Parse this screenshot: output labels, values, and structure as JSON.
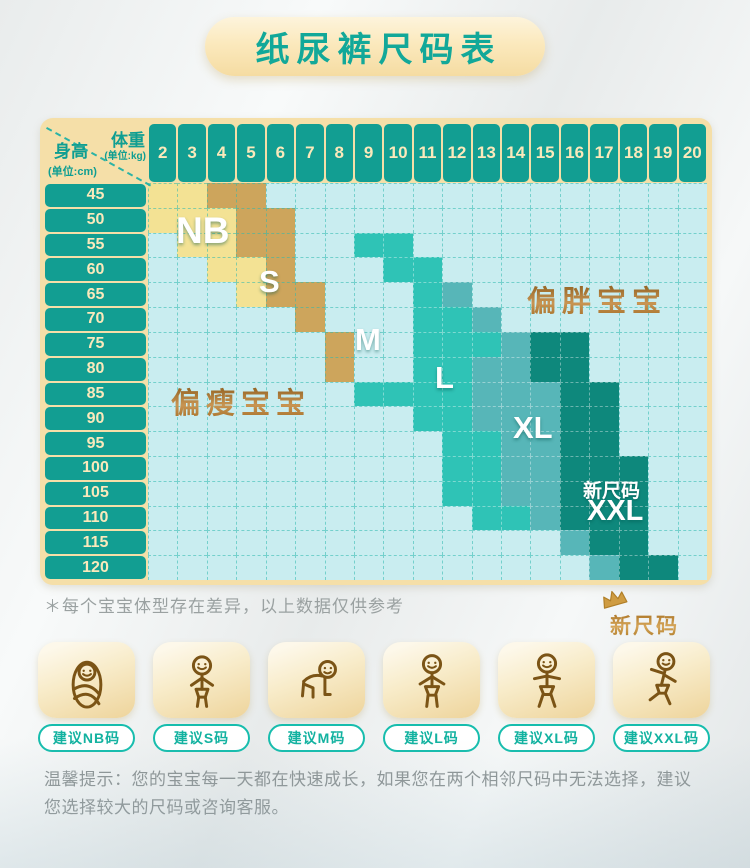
{
  "title": "纸尿裤尺码表",
  "colors": {
    "header_teal": "#129e92",
    "frame_cream": "#f5dfa8",
    "title_text": "#12a899",
    "pill_teal": "#16bdad",
    "brown_text": "#a8731f"
  },
  "table": {
    "corner": {
      "weight_label": "体重",
      "weight_unit": "(单位:kg)",
      "height_label": "身高",
      "height_unit": "(单位:cm)"
    },
    "labels": {
      "nb": "NB",
      "s": "S",
      "m": "M",
      "l": "L",
      "xl": "XL",
      "xxl": "XXL",
      "new_size": "新尺码",
      "chubby": "偏胖宝宝",
      "slim": "偏瘦宝宝"
    }
  },
  "chart_data": {
    "type": "heatmap",
    "title": "纸尿裤尺码表",
    "x_label": "体重(单位:kg)",
    "y_label": "身高(单位:cm)",
    "x": [
      "2",
      "3",
      "4",
      "5",
      "6",
      "7",
      "8",
      "9",
      "10",
      "11",
      "12",
      "13",
      "14",
      "15",
      "16",
      "17",
      "18",
      "19",
      "20"
    ],
    "y": [
      "45",
      "50",
      "55",
      "60",
      "65",
      "70",
      "75",
      "80",
      "85",
      "90",
      "95",
      "100",
      "105",
      "110",
      "115",
      "120"
    ],
    "legend": {
      "Y": "NB(浅黄)",
      "G": "S(金色)",
      "B": "背景/M标注区(浅青)",
      "L": "L(亮青绿)",
      "X": "XL(中青绿)",
      "D": "XXL新尺码(深青绿)"
    },
    "cell_code_colors": {
      "Y": "#f3e294",
      "G": "#cda55c",
      "B": "#c9edf0",
      "L": "#2fc3b6",
      "X": "#57b6b8",
      "D": "#0e887c"
    },
    "grid": [
      "YYGGBBBBBBBBBBBBBBB",
      "YYYGGBBBBBBBBBBBBBB",
      "BYYGGBBLLBBBBBBBBBB",
      "BBYYGBBBLLBBBBBBBBB",
      "BBBYGGBBBLXBBBBBBBB",
      "BBBBBGBBBLLXBBBBBBB",
      "BBBBBBGBBLLLXDDBBBB",
      "BBBBBBGBBLLXXDDBBBB",
      "BBBBBBBLLLLXXXDDBBB",
      "BBBBBBBBBLLXXXDDBBB",
      "BBBBBBBBBBLLXXDDBBB",
      "BBBBBBBBBBLLXXDDDBB",
      "BBBBBBBBBBLLXXDDDBB",
      "BBBBBBBBBBBLLXDDDBB",
      "BBBBBBBBBBBBBBXDDBB",
      "BBBBBBBBBBBBBBBXDDB"
    ]
  },
  "note": "＊每个宝宝体型存在差异，以上数据仅供参考",
  "new_size_badge": "新尺码",
  "recommendations": [
    {
      "icon": "swaddled-baby-icon",
      "label": "建议NB码"
    },
    {
      "icon": "baby-standing-icon",
      "label": "建议S码"
    },
    {
      "icon": "crawling-baby-icon",
      "label": "建议M码"
    },
    {
      "icon": "toddler-diaper-icon",
      "label": "建议L码"
    },
    {
      "icon": "walking-toddler-icon",
      "label": "建议XL码"
    },
    {
      "icon": "running-toddler-icon",
      "label": "建议XXL码"
    }
  ],
  "tip": {
    "line1": "温馨提示：您的宝宝每一天都在快速成长，如果您在两个相邻尺码中无法选择，建议",
    "line2": "您选择较大的尺码或咨询客服。"
  }
}
